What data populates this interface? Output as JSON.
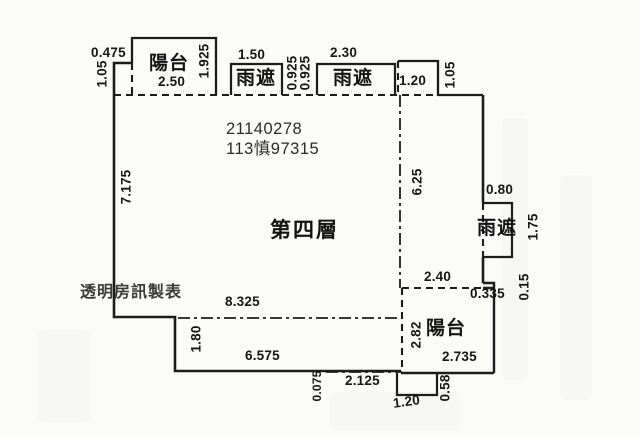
{
  "canvas": {
    "background": "#fbfbf8",
    "line_color": "#1c1c1c"
  },
  "floor_plan": {
    "floor_label": "第四層",
    "case_number": "21140278",
    "registry_number": "113慎97315",
    "credit": "透明房訊製表",
    "rooms": {
      "balcony_top": "陽台",
      "balcony_bottom": "陽台",
      "canopy_top_left": "雨遮",
      "canopy_top_mid": "雨遮",
      "canopy_right": "雨遮"
    },
    "dims": {
      "tl_step_w": "0.475",
      "tl_step_h": "1.05",
      "balcony_top_w": "2.50",
      "balcony_top_d": "1.925",
      "canopy1_w": "1.50",
      "canopy1_d": "0.925",
      "canopy2_d": "0.925",
      "canopy2_w": "2.30",
      "notch_w": "1.20",
      "notch_h": "1.05",
      "left_wall": "7.175",
      "interior_v": "6.25",
      "canopy_r_w": "0.80",
      "canopy_r_d": "1.75",
      "br_top": "2.40",
      "br_step_w": "0.335",
      "br_step_h": "0.15",
      "interior_h": "8.325",
      "bl_step_h": "1.80",
      "bottom_wall": "6.575",
      "bottom_offset": "0.075",
      "balcony_br_h": "2.82",
      "balcony_br_w": "2.735",
      "bottom_measure": "2.125",
      "duct_w": "1.20",
      "duct_h": "0.58"
    }
  }
}
